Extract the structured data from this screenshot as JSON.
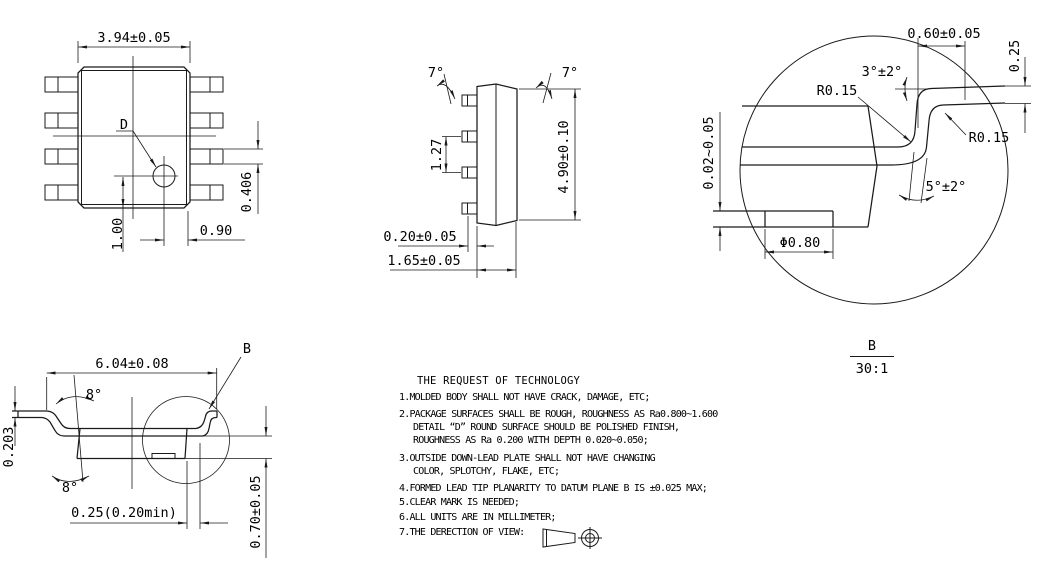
{
  "drawing": {
    "top_view": {
      "dim_body_width": "3.94±0.05",
      "dimple_label": "D",
      "dim_pin_width": "0.406",
      "dim_dimple_y": "1.00",
      "dim_dimple_x": "0.90"
    },
    "side_view": {
      "angle_left": "7°",
      "angle_right": "7°",
      "dim_pin_pitch": "1.27",
      "dim_body_length": "4.90±0.10",
      "dim_lead_thickness": "0.20±0.05",
      "dim_body_thickness": "1.65±0.05"
    },
    "front_view": {
      "dim_overall_width": "6.04±0.08",
      "angle_top": "8°",
      "angle_bottom": "8°",
      "dim_lead_thickness": "0.203",
      "dim_lead_tip": "0.25(0.20min)",
      "dim_standoff": "0.70±0.05",
      "detail_label": "B"
    },
    "detail_b": {
      "dim_foot_length": "0.60±0.05",
      "dim_foot_thickness": "0.25",
      "angle_foot": "3°±2°",
      "radius_left": "R0.15",
      "radius_right": "R0.15",
      "dim_pad_height": "0.02~0.05",
      "angle_lead": "5°±2°",
      "dim_pad_width": "Φ0.80",
      "label": "B",
      "scale": "30:1"
    },
    "notes": {
      "title": "THE REQUEST OF TECHNOLOGY",
      "lines": [
        "1.MOLDED BODY SHALL NOT HAVE CRACK, DAMAGE, ETC;",
        "2.PACKAGE SURFACES SHALL BE ROUGH, ROUGHNESS AS Ra0.800~1.600",
        "DETAIL “D” ROUND SURFACE SHOULD BE POLISHED FINISH,",
        "ROUGHNESS AS Ra 0.200 WITH DEPTH 0.020~0.050;",
        "3.OUTSIDE DOWN-LEAD PLATE SHALL NOT HAVE CHANGING",
        "COLOR, SPLOTCHY, FLAKE, ETC;",
        "4.FORMED LEAD TIP PLANARITY TO DATUM PLANE B IS ±0.025 MAX;",
        "5.CLEAR MARK IS NEEDED;",
        "6.ALL UNITS ARE IN MILLIMETER;",
        "7.THE DERECTION OF VIEW:"
      ]
    }
  }
}
